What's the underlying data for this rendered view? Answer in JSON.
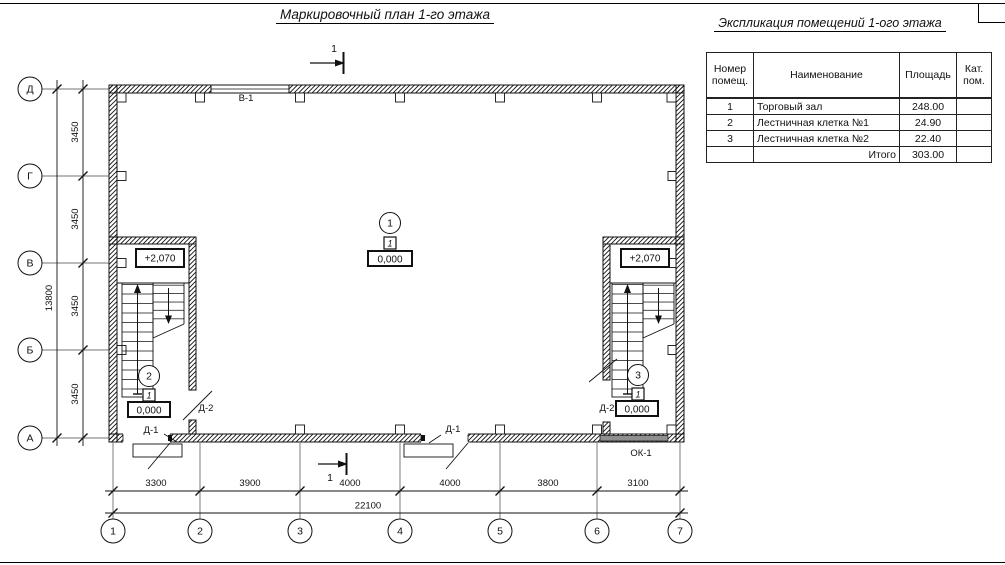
{
  "sheet": {
    "plan_title": "Маркировочный план 1-го этажа",
    "table_title": "Экспликация помещений 1-ого этажа"
  },
  "plan": {
    "section_label": "1",
    "labels": {
      "window_top": "В-1",
      "window_bottom": "ОК-1",
      "door_1": "Д-1",
      "door_2": "Д-2",
      "elev_upper": "+2,070",
      "elev_zero": "0,000",
      "floor_square": "1"
    },
    "rooms": [
      "1",
      "2",
      "3"
    ],
    "axes_bottom": [
      "1",
      "2",
      "3",
      "4",
      "5",
      "6",
      "7"
    ],
    "axes_left": [
      "Д",
      "Г",
      "В",
      "Б",
      "А"
    ],
    "dims_bottom": [
      "3300",
      "3900",
      "4000",
      "4000",
      "3800",
      "3100"
    ],
    "dim_bottom_total": "22100",
    "dims_left": [
      "3450",
      "3450",
      "3450",
      "3450"
    ],
    "dim_left_total": "13800"
  },
  "table": {
    "headers": {
      "number": "Номер помещ.",
      "name": "Наименование",
      "area": "Площадь",
      "cat": "Кат. пом."
    },
    "rows": [
      {
        "number": "1",
        "name": "Торговый зал",
        "area": "248.00",
        "cat": ""
      },
      {
        "number": "2",
        "name": "Лестничная клетка №1",
        "area": "24.90",
        "cat": ""
      },
      {
        "number": "3",
        "name": "Лестничная клетка №2",
        "area": "22.40",
        "cat": ""
      }
    ],
    "total_label": "Итого",
    "total_value": "303.00"
  }
}
